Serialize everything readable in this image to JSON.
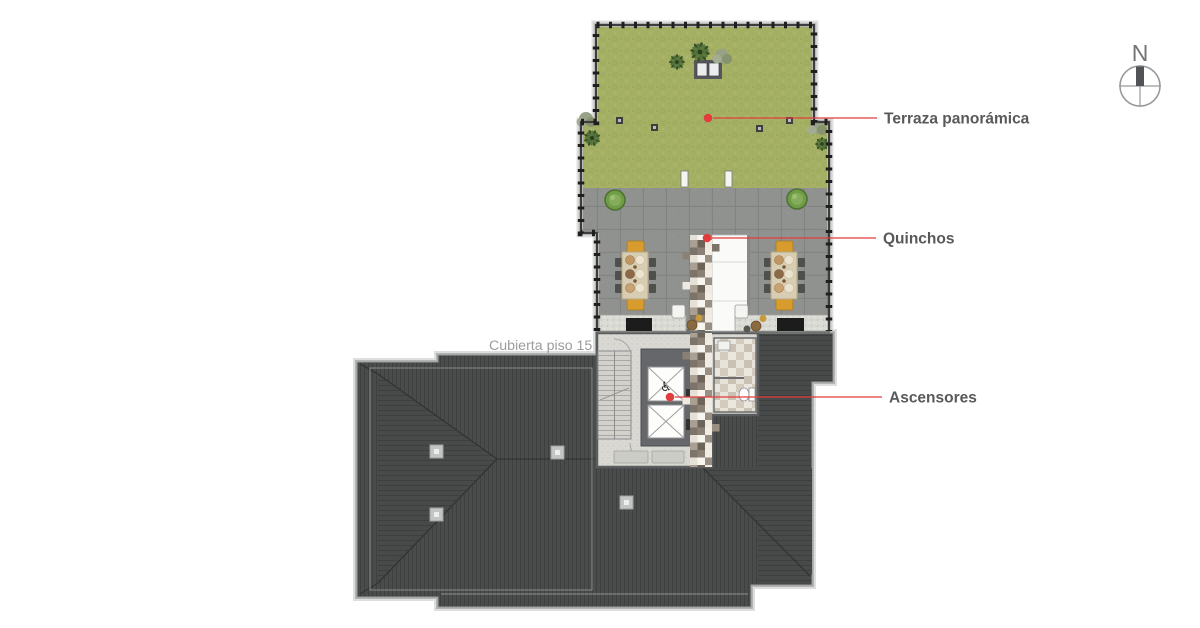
{
  "callouts": [
    {
      "label": "Terraza panorámica"
    },
    {
      "label": "Quinchos"
    },
    {
      "label": "Ascensores"
    }
  ],
  "plan": {
    "floor_label": "Cubierta piso 15"
  },
  "compass": {
    "north_label": "N"
  },
  "core": {
    "accessible_glyph": "♿"
  },
  "colors": {
    "accent_red": "#e23c3c",
    "label_text": "#58595b",
    "muted_label": "#9b9c9e",
    "grass_green": "#a5b065",
    "paver_gray": "#909290",
    "roof_dark": "#4a4c4c",
    "core_floor": "#d9d8d3",
    "bench_orange": "#d79b2d",
    "compass_gray": "#98999b",
    "background": "#ffffff"
  }
}
